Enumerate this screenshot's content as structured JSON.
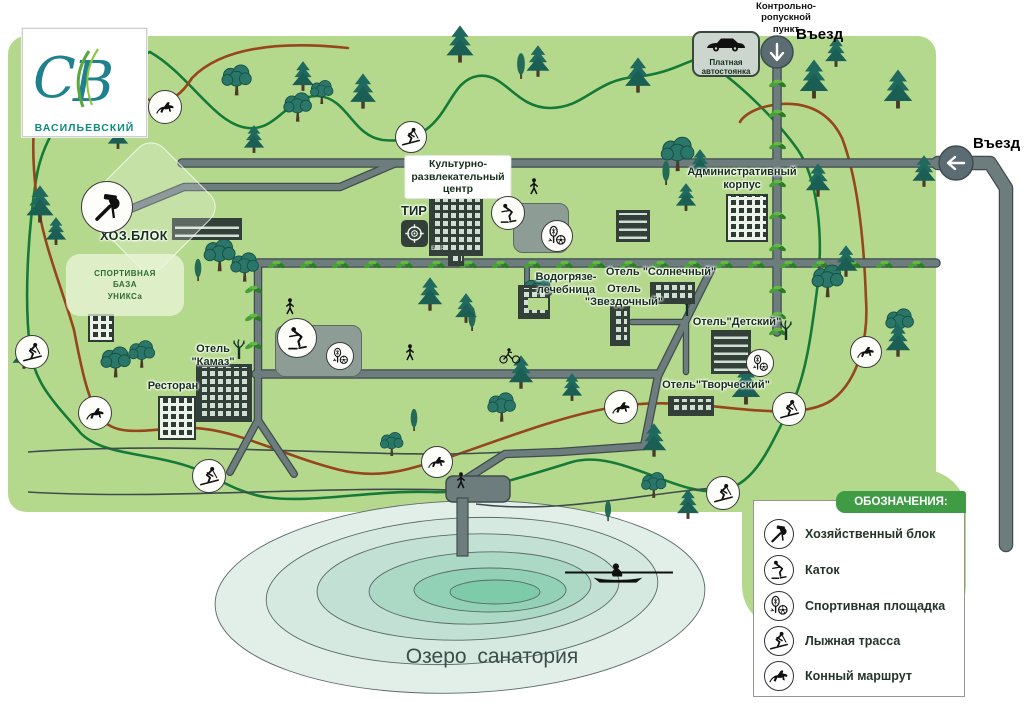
{
  "logo": {
    "monogram": "СВ",
    "name": "ВАСИЛЬЕВСКИЙ"
  },
  "entrances": {
    "top_label": "Въезд",
    "right_label": "Въезд",
    "checkpoint": "Контрольно-\nропускной\nпункт",
    "parking": "Платная\nавтостоянка"
  },
  "buildings": {
    "cultural_center": "Культурно-\nразвлекательный\nцентр",
    "bar": "БАР",
    "tir": "ТИР",
    "admin": "Административный\nкорпус",
    "spa": "Водогрязе-\nлечебница",
    "hotel_sunny": "Отель \"Солнечный\"",
    "hotel_star": "Отель\n\"Звездочный\"",
    "hotel_kids": "Отель\"Детский\"",
    "hotel_creative": "Отель\"Творческий\"",
    "hotel_kamaz": "Отель\n\"Камаз\"",
    "restaurant": "Ресторан",
    "hoz_block": "ХОЗ.БЛОК",
    "sport_base": "СПОРТИВНАЯ\nБАЗА\nУНИКСа"
  },
  "lake": {
    "label": "Озеро  санатория"
  },
  "legend": {
    "title": "ОБОЗНАЧЕНИЯ:",
    "items": [
      {
        "icon": "tools-icon",
        "label": "Хозяйственный блок"
      },
      {
        "icon": "skate-icon",
        "label": "Каток"
      },
      {
        "icon": "sport-icon",
        "label": "Спортивная площадка"
      },
      {
        "icon": "ski-icon",
        "label": "Лыжная трасса"
      },
      {
        "icon": "horse-icon",
        "label": "Конный маршрут"
      }
    ]
  },
  "colors": {
    "map_green": "#b5d98c",
    "road_gray": "#6d7d7e",
    "ski_trail": "#157a38",
    "horse_trail": "#96451c",
    "legend_green": "#3f9b44",
    "lake_outer": "#e2efe9",
    "lake_inner": "#7ecbaa",
    "building_dark": "#333f39",
    "logo_teal": "#0f8a80"
  }
}
